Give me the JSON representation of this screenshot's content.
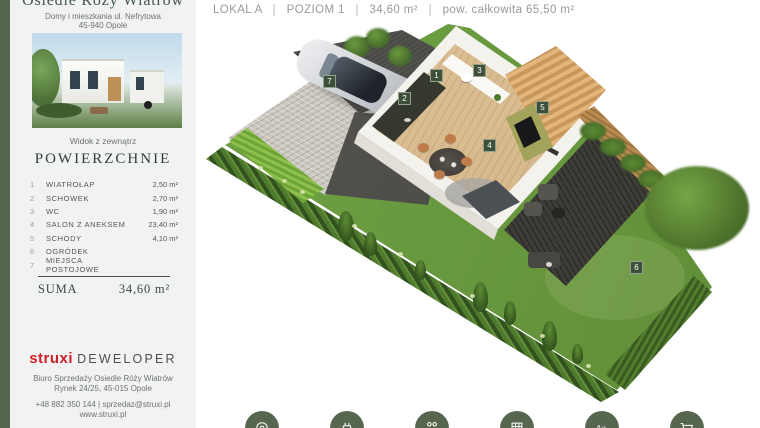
{
  "header": {
    "unit": "LOKAL A",
    "separator": "|",
    "level": "POZIOM 1",
    "area": "34,60 m²",
    "total_area": "pow. całkowita 65,50 m²"
  },
  "sidebar": {
    "title": "Osiedle Róży Wiatrów",
    "subtitle_line1": "Domy i mieszkania ul. Nefrytowa",
    "subtitle_line2": "45-940 Opole",
    "photo_caption": "Widok z zewnątrz",
    "section_title": "POWIERZCHNIE",
    "rooms": [
      {
        "no": "1",
        "name": "WIATROŁAP",
        "area": "2,50 m²"
      },
      {
        "no": "2",
        "name": "SCHOWEK",
        "area": "2,70 m²"
      },
      {
        "no": "3",
        "name": "WC",
        "area": "1,90 m²"
      },
      {
        "no": "4",
        "name": "SALON Z ANEKSEM",
        "area": "23,40 m²"
      },
      {
        "no": "5",
        "name": "SCHODY",
        "area": "4,10 m²"
      },
      {
        "no": "6",
        "name": "OGRÓDEK",
        "area": ""
      },
      {
        "no": "7",
        "name": "MIEJSCA POSTOJOWE",
        "area": ""
      }
    ],
    "suma_label": "SUMA",
    "suma_value": "34,60 m²",
    "logo_primary": "struxi",
    "logo_secondary": "DEWELOPER",
    "office_line1": "Biuro Sprzedaży Osiedle Róży Wiatrów",
    "office_line2": "Rynek 24/25, 45-015 Opole",
    "contact_line1": "+48 882 350 144 | sprzedaz@struxi.pl",
    "contact_line2": "www.struxi.pl"
  },
  "plan": {
    "markers": [
      {
        "no": "1",
        "x": 437,
        "y": 76
      },
      {
        "no": "2",
        "x": 405,
        "y": 99
      },
      {
        "no": "3",
        "x": 480,
        "y": 71
      },
      {
        "no": "4",
        "x": 490,
        "y": 146
      },
      {
        "no": "5",
        "x": 543,
        "y": 108
      },
      {
        "no": "6",
        "x": 637,
        "y": 268
      },
      {
        "no": "7",
        "x": 330,
        "y": 82
      }
    ]
  },
  "footer": {
    "icons": [
      {
        "name": "location-icon",
        "glyph": "location"
      },
      {
        "name": "ev-charger-icon",
        "glyph": "ev_charger"
      },
      {
        "name": "family-icon",
        "glyph": "family"
      },
      {
        "name": "playground-icon",
        "glyph": "playground"
      },
      {
        "name": "school-icon",
        "glyph": "school"
      },
      {
        "name": "shopping-cart-icon",
        "glyph": "cart"
      }
    ]
  },
  "colors": {
    "accent_green": "#57664f",
    "marker_green": "#3e5039",
    "logo_red": "#cf2127",
    "grass_green": "#6b9c40"
  }
}
